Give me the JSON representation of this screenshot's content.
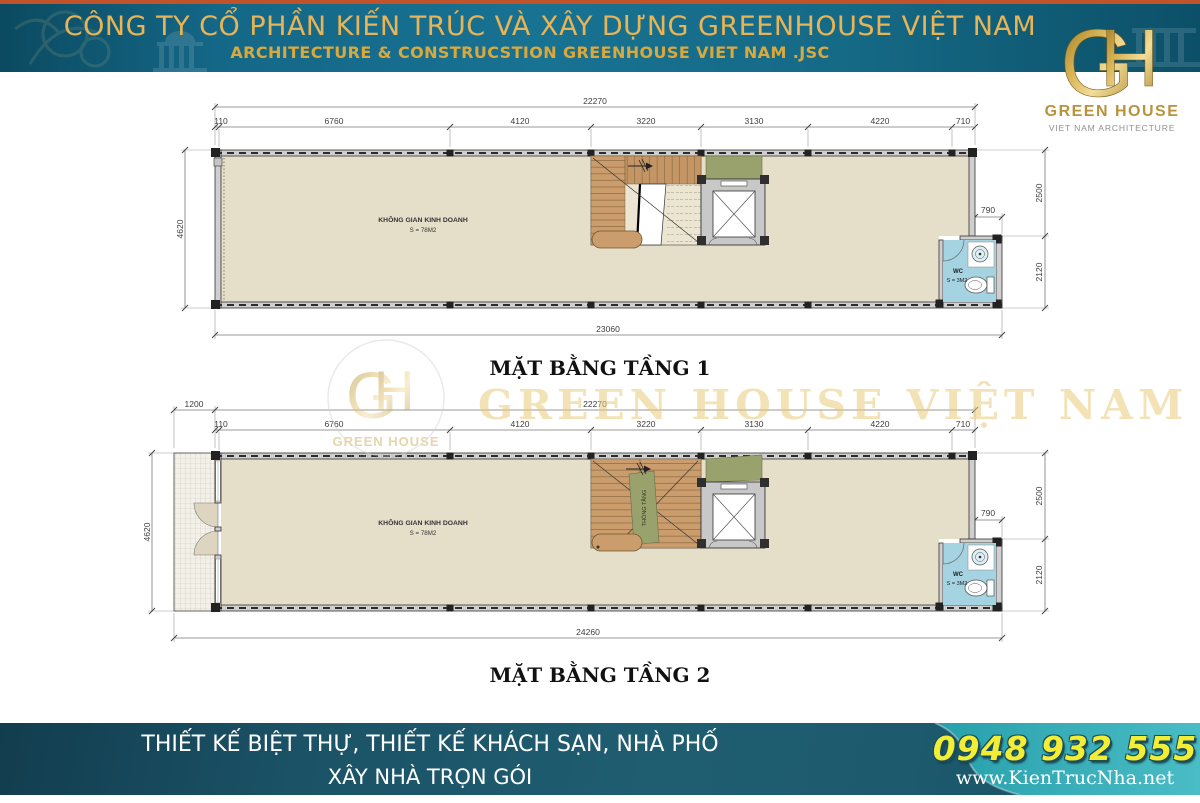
{
  "header": {
    "title": "CÔNG TY CỔ PHẦN KIẾN TRÚC VÀ XÂY DỰNG GREENHOUSE VIỆT NAM",
    "subtitle": "ARCHITECTURE & CONSTRUCSTION GREENHOUSE VIET NAM .JSC",
    "logo": {
      "monogram_g": "G",
      "monogram_h": "H",
      "name": "GREEN HOUSE",
      "tagline": "VIET NAM ARCHITECTURE"
    }
  },
  "watermark": {
    "text": "GREEN HOUSE VIỆT NAM",
    "logo": {
      "monogram_g": "G",
      "monogram_h": "H",
      "name": "GREEN HOUSE",
      "tagline": "VIET NAM ARCHITECTURE"
    }
  },
  "plan1": {
    "title": "MẶT BẰNG TẦNG 1",
    "room": {
      "name": "KHÔNG GIAN KINH DOANH",
      "area": "S = 78M2"
    },
    "wc": {
      "name": "WC",
      "area": "S = 3M2"
    },
    "dims": {
      "overall_top": "22270",
      "segments": [
        "110",
        "6760",
        "4120",
        "3220",
        "3130",
        "4220",
        "710"
      ],
      "left": "4620",
      "right_upper": "2500",
      "right_lower": "2120",
      "wc_offset": "790",
      "overall_bottom": "23060"
    }
  },
  "plan2": {
    "title": "MẶT BẰNG TẦNG 2",
    "room": {
      "name": "KHÔNG GIAN KINH DOANH",
      "area": "S = 78M2"
    },
    "wc": {
      "name": "WC",
      "area": "S = 3M2"
    },
    "void_label": "THÔNG TẦNG",
    "dims": {
      "balcony": "1200",
      "overall_top": "22270",
      "segments": [
        "110",
        "6760",
        "4120",
        "3220",
        "3130",
        "4220",
        "710"
      ],
      "left": "4620",
      "right_upper": "2500",
      "right_lower": "2120",
      "wc_offset": "790",
      "overall_bottom": "24260"
    }
  },
  "footer": {
    "line1": "THIẾT KẾ BIỆT THỰ, THIẾT KẾ KHÁCH SẠN, NHÀ PHỐ",
    "line2": "XÂY NHÀ TRỌN GÓI",
    "phone": "0948 932 555",
    "website": "www.KienTrucNha.net"
  },
  "colors": {
    "header_teal": "#176d89",
    "accent_orange": "#c0532a",
    "gold": "#d4af4e",
    "floor_beige": "#e5dfca",
    "stair_brown": "#cb9c6c",
    "void_green": "#99a26d",
    "wc_blue": "#a5d3e2",
    "footer_teal": "#2fa7b2",
    "phone_yellow": "#f2ee35"
  }
}
